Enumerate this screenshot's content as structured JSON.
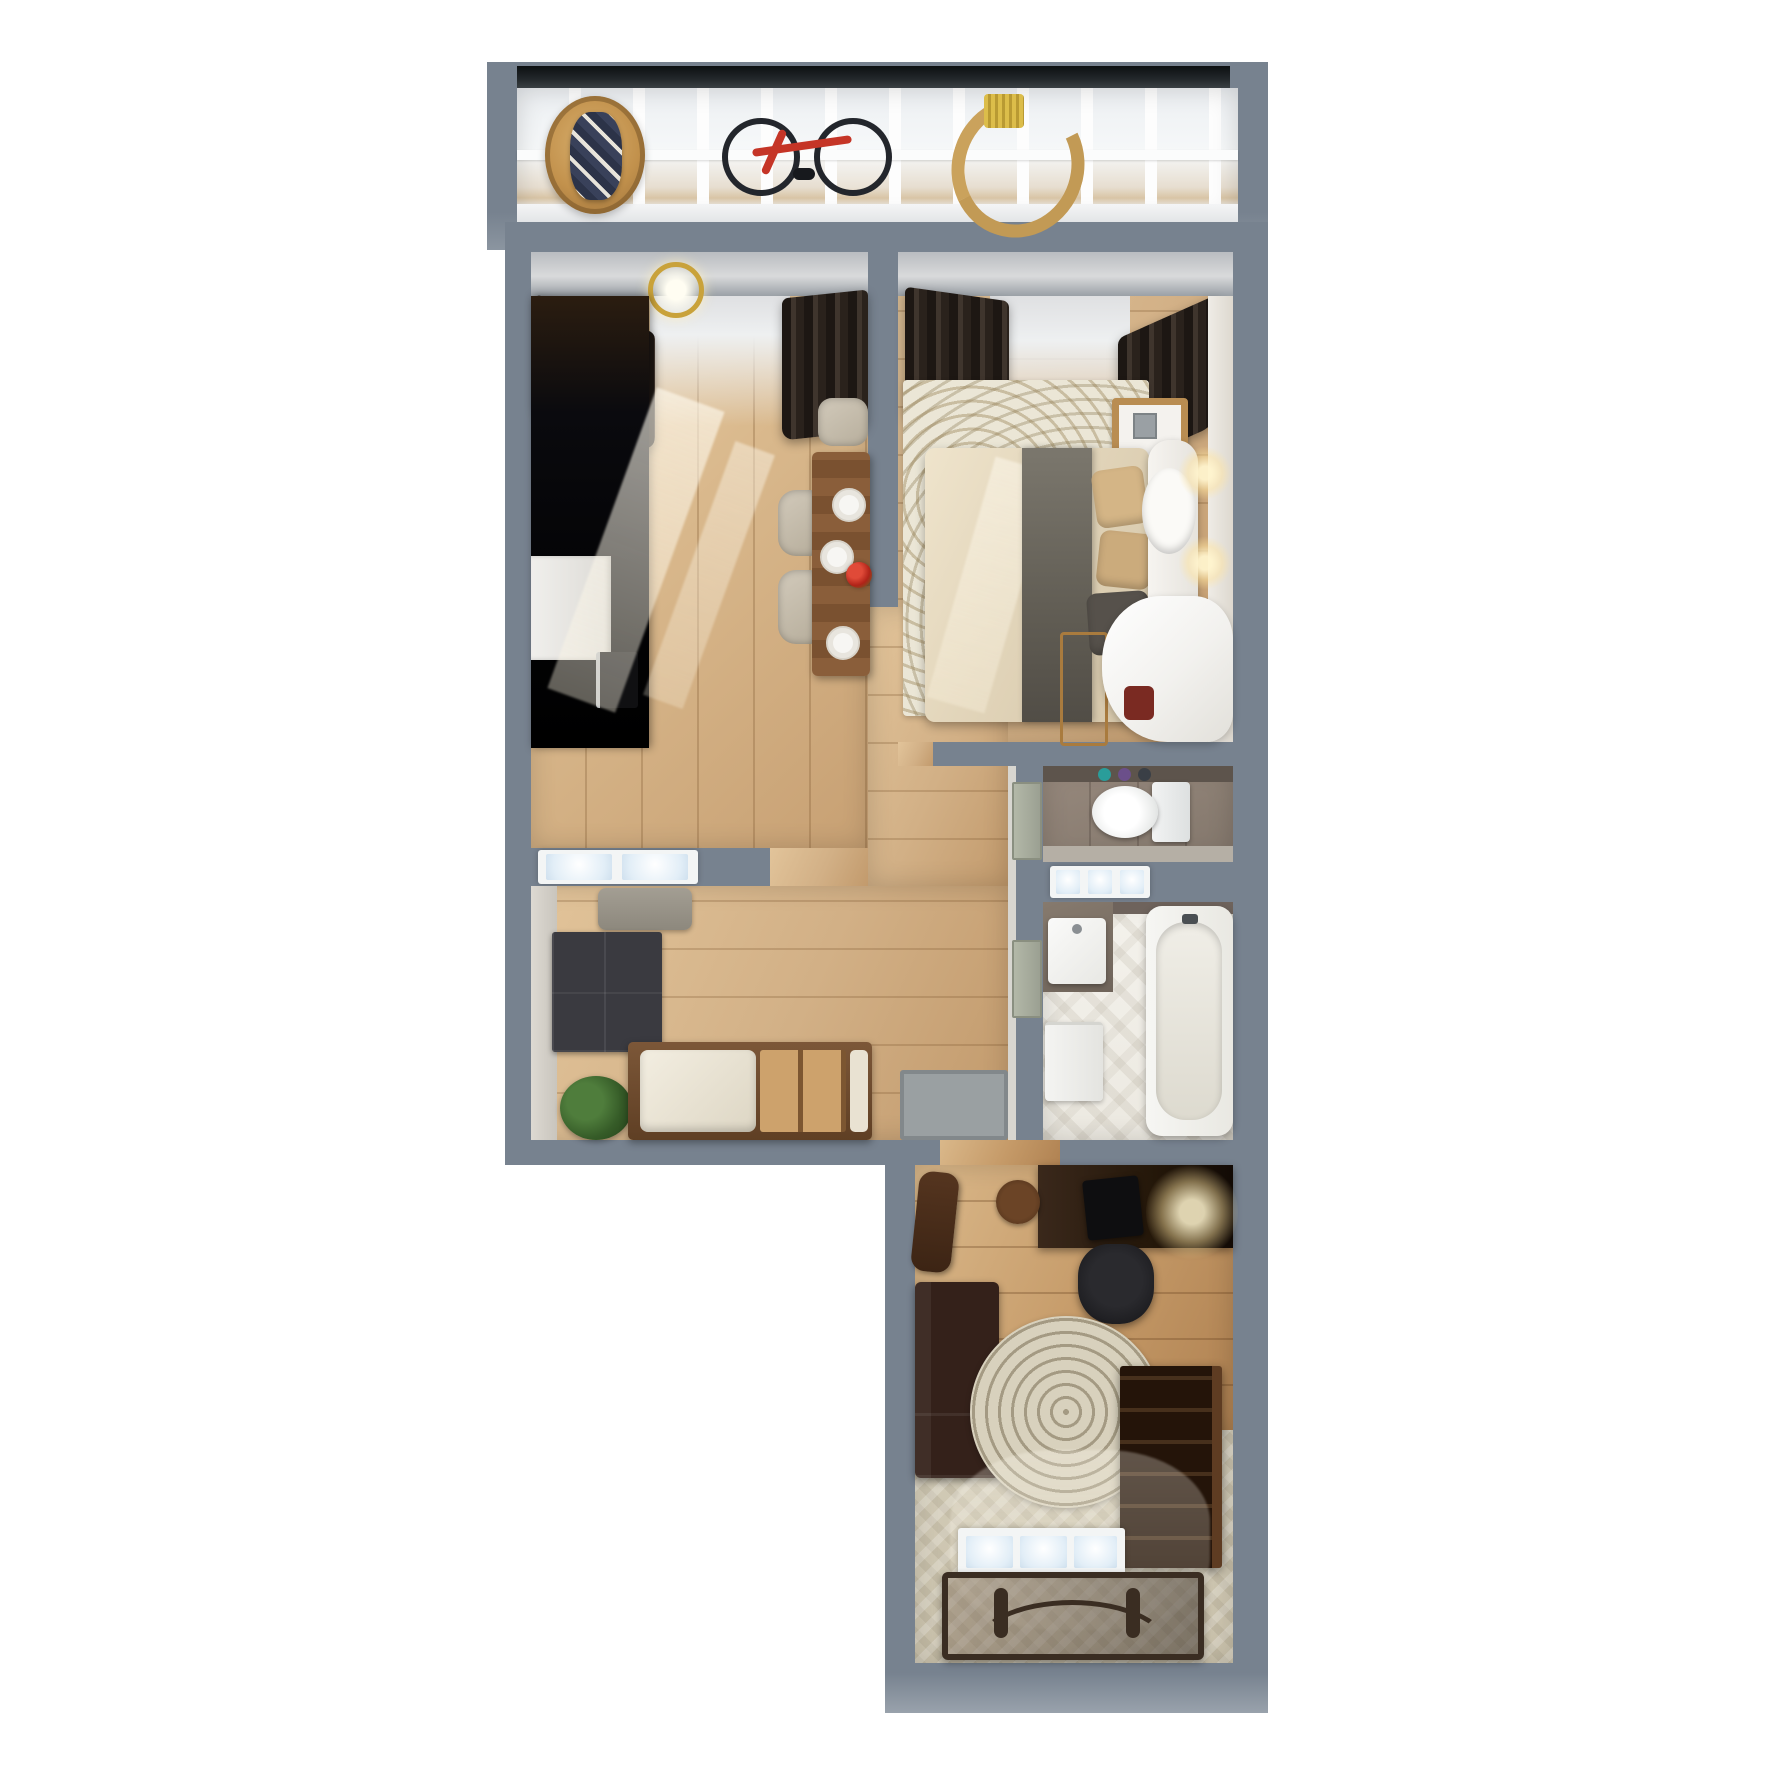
{
  "scene": {
    "title": "3d-apartment-floor-plan-top-down-render",
    "background": "#ffffff",
    "wall_color": "#77828f",
    "wall_color_light": "#99a2ac",
    "window_frame_dark": "#15181a",
    "floor_wood": "#d2b186",
    "floor_wood_dark": "#c49a6d",
    "tile_taupe": "#8b7f74",
    "tile_white": "#f1efe9",
    "carpet": "#cfc7b2",
    "curtain": "#2f2823",
    "accent_red": "#c43527",
    "glow_warm": "#ffdf9e"
  },
  "rooms": {
    "balcony": {
      "label": "balcony",
      "items": [
        "glazed-window-wall",
        "hanging-wicker-chair",
        "plaid-blanket",
        "bicycle",
        "wooden-rocker"
      ]
    },
    "kitchen_living": {
      "label": "kitchen-living-room",
      "items": [
        "blackout-curtains",
        "chandelier",
        "black-wardrobe",
        "kitchen-cabinets",
        "white-counter",
        "oven",
        "dining-table",
        "dining-chairs",
        "plates",
        "red-flowers",
        "sunlight-streaks"
      ]
    },
    "bedroom": {
      "label": "bedroom",
      "items": [
        "blackout-curtains",
        "double-bed",
        "beige-pillows",
        "gray-throw",
        "white-headboard",
        "wall-sconces",
        "nightstand",
        "patterned-rug",
        "baby-crib",
        "white-canopy"
      ]
    },
    "hallway": {
      "label": "hallway",
      "items": [
        "wood-floor"
      ]
    },
    "entry": {
      "label": "entry-hall",
      "items": [
        "gray-bench",
        "dark-wardrobe",
        "plant",
        "platform-daybed",
        "doormat"
      ]
    },
    "toilet": {
      "label": "toilet-room",
      "items": [
        "toilet",
        "towel-shelf"
      ]
    },
    "bathroom": {
      "label": "bathroom",
      "items": [
        "bathtub",
        "sink-vanity",
        "washing-machine",
        "chevron-tile-floor",
        "transom-window"
      ]
    },
    "lounge": {
      "label": "living-room-study",
      "items": [
        "desk",
        "monitor",
        "office-chair",
        "desk-lamp-glow",
        "side-table",
        "open-door",
        "leather-sofa",
        "round-dotted-rug",
        "bookshelf",
        "window",
        "glass-console",
        "carpet"
      ]
    }
  }
}
